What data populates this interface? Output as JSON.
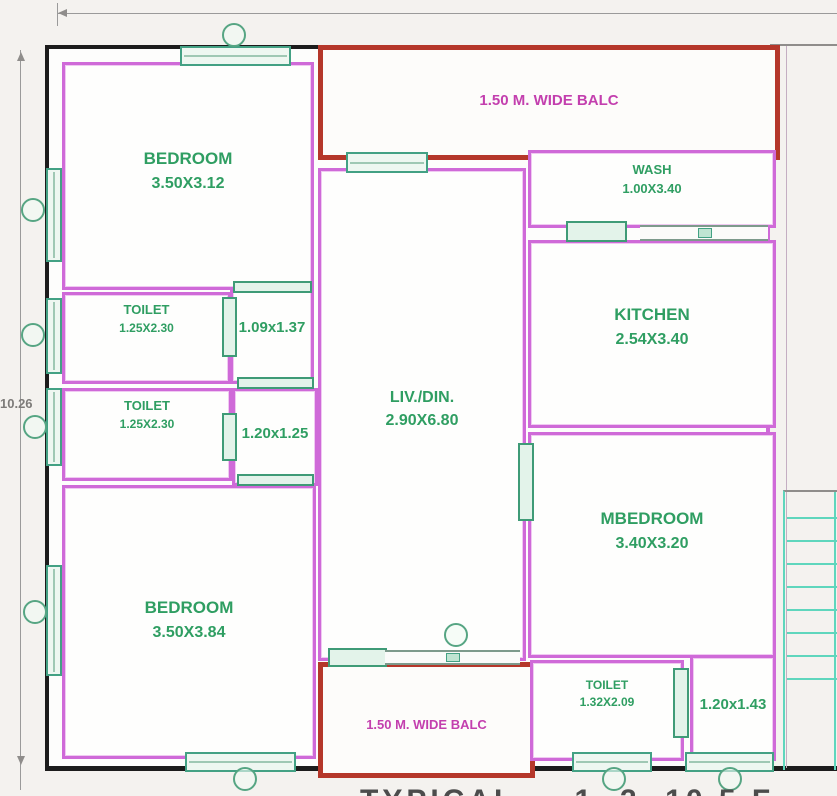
{
  "drawing_type": "floor-plan",
  "rooms": {
    "bedroom_tl": {
      "name": "BEDROOM",
      "dims": "3.50X3.12"
    },
    "toilet_1": {
      "name": "TOILET",
      "dims": "1.25X2.30"
    },
    "room_109": {
      "name": "",
      "dims": "1.09x1.37"
    },
    "toilet_2": {
      "name": "TOILET",
      "dims": "1.25X2.30"
    },
    "room_120": {
      "name": "",
      "dims": "1.20x1.25"
    },
    "bedroom_bl": {
      "name": "BEDROOM",
      "dims": "3.50X3.84"
    },
    "livdin": {
      "name": "LIV./DIN.",
      "dims": "2.90X6.80"
    },
    "wash": {
      "name": "WASH",
      "dims": "1.00X3.40"
    },
    "kitchen": {
      "name": "KITCHEN",
      "dims": "2.54X3.40"
    },
    "mbedroom": {
      "name": "MBEDROOM",
      "dims": "3.40X3.20"
    },
    "toilet_br": {
      "name": "TOILET",
      "dims": "1.32X2.09"
    },
    "room_143": {
      "name": "",
      "dims": "1.20x1.43"
    }
  },
  "balconies": {
    "top": {
      "label": "1.50 M. WIDE BALC"
    },
    "bottom": {
      "label": "1.50 M. WIDE BALC"
    }
  },
  "dimensions": {
    "left_total": "10.26"
  },
  "caption": {
    "text": "TYPICAL — 1, 2, 10 5 F"
  },
  "colors": {
    "wall_magenta": "#cf6ad8",
    "balcony_red": "#b5372a",
    "room_text_green": "#2f9e62",
    "balcony_text_magenta": "#c33fae",
    "opening_green": "#43a184",
    "stair_cyan": "#5fd6bd",
    "dimension_gray": "#9a9a9a"
  }
}
